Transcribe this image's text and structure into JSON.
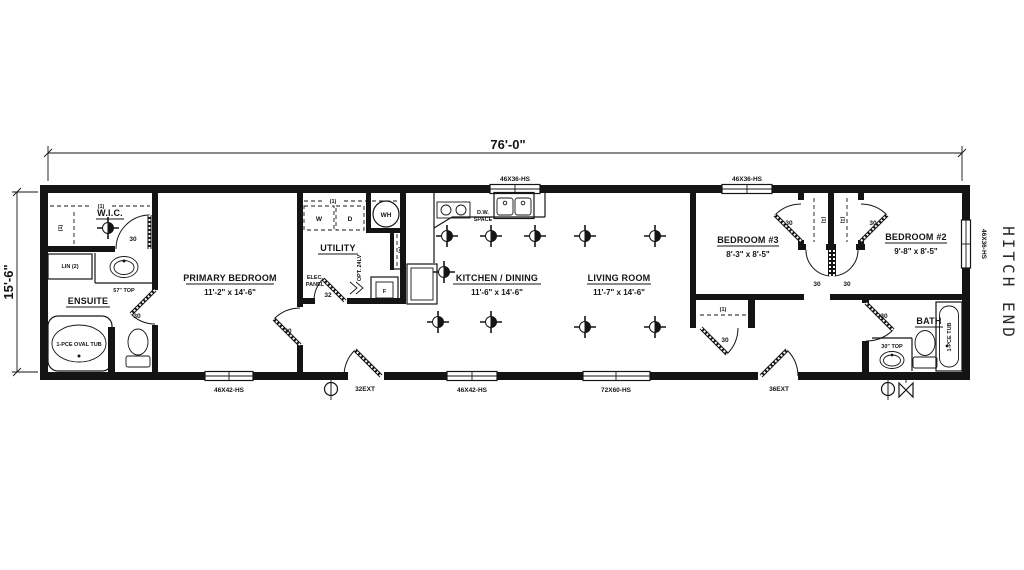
{
  "dimensions": {
    "overall_width": "76'-0\"",
    "overall_height": "15'-6\""
  },
  "hitch_label": "HITCH END",
  "rooms": {
    "wic": {
      "name": "W.I.C."
    },
    "ensuite": {
      "name": "ENSUITE"
    },
    "primary": {
      "name": "PRIMARY BEDROOM",
      "size": "11'-2\" x 14'-6\""
    },
    "utility": {
      "name": "UTILITY"
    },
    "kitchen": {
      "name": "KITCHEN / DINING",
      "size": "11'-6\" x 14'-6\""
    },
    "living": {
      "name": "LIVING ROOM",
      "size": "11'-7\" x 14'-6\""
    },
    "bedroom3": {
      "name": "BEDROOM #3",
      "size": "8'-3\" x 8'-5\""
    },
    "bedroom2": {
      "name": "BEDROOM #2",
      "size": "9'-8\" x 8'-5\""
    },
    "bath": {
      "name": "BATH"
    }
  },
  "fixtures": {
    "oval_tub": "1-PCE OVAL TUB",
    "tub": "1-PCE TUB",
    "linen": "LIN (2)",
    "vanity57": "57\" TOP",
    "vanity30": "30\" TOP",
    "water_heater": "WH",
    "washer": "W",
    "dryer": "D",
    "dw_line1": "D.W.",
    "dw_line2": "SPACE",
    "elec_line1": "ELEC.",
    "elec_line2": "PANEL",
    "opt_lav": "OPT. 24LV",
    "furnace": "F"
  },
  "openings": {
    "door30": "30",
    "door32": "32",
    "door32ext": "32EXT",
    "door36ext": "36EXT",
    "win_46x36": "46X36-HS",
    "win_46x42": "46X42-HS",
    "win_72x60": "72X60-HS"
  },
  "marks": {
    "shelf": "(1)"
  }
}
